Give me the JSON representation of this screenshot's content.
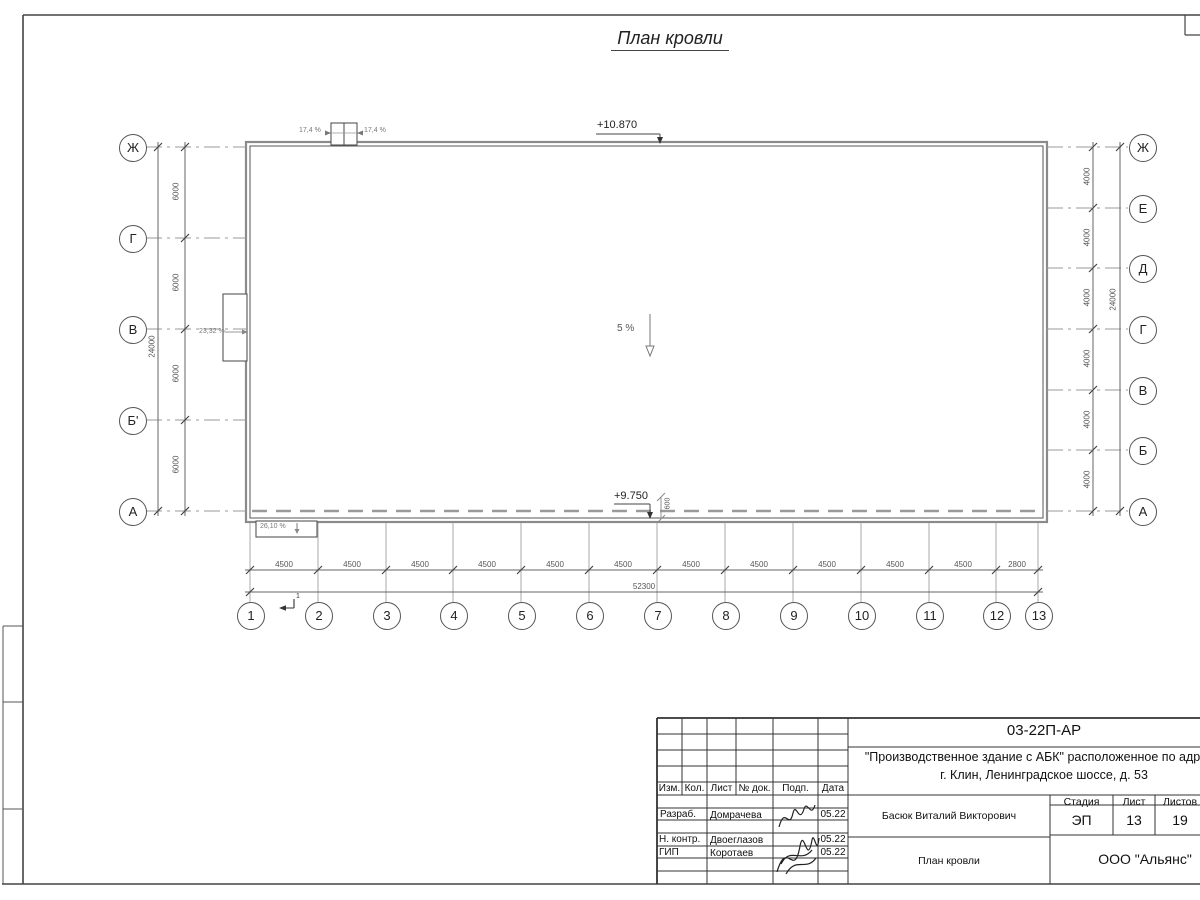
{
  "drawing": {
    "title": "План кровли"
  },
  "plan": {
    "elevation_top": "+10.870",
    "elevation_bottom": "+9.750",
    "slope_main": "5 %",
    "slope_left_canopy": "23,32 %",
    "slope_bottom_canopy": "26,10 %",
    "slope_vent_left": "17,4 %",
    "slope_vent_right": "17,4 %",
    "parapet_dim": "600",
    "section_mark": "1"
  },
  "axes": {
    "left": [
      "Ж",
      "Г",
      "В",
      "Б'",
      "А"
    ],
    "right": [
      "Ж",
      "Е",
      "Д",
      "Г",
      "В",
      "Б",
      "А"
    ],
    "bottom": [
      "1",
      "2",
      "3",
      "4",
      "5",
      "6",
      "7",
      "8",
      "9",
      "10",
      "11",
      "12",
      "13"
    ]
  },
  "dims": {
    "bottom_segments": [
      "4500",
      "4500",
      "4500",
      "4500",
      "4500",
      "4500",
      "4500",
      "4500",
      "4500",
      "4500",
      "4500",
      "2800"
    ],
    "bottom_total": "52300",
    "left_segments": [
      "6000",
      "6000",
      "6000",
      "6000"
    ],
    "left_total": "24000",
    "right_segments": [
      "4000",
      "4000",
      "4000",
      "4000",
      "4000",
      "4000"
    ],
    "right_total": "24000"
  },
  "titleblock": {
    "doc_code": "03-22П-АР",
    "project_line1": "\"Производственное здание с АБК\" расположенное по адресу:",
    "project_line2": "г. Клин, Ленинградское шоссе, д. 53",
    "header_cols": [
      "Изм.",
      "Кол.",
      "Лист",
      "№ док.",
      "Подп.",
      "Дата"
    ],
    "rows": [
      {
        "role": "Разраб.",
        "name": "Домрачева",
        "date": "05.22"
      },
      {
        "role": "Н. контр.",
        "name": "Двоеглазов",
        "date": "05.22"
      },
      {
        "role": "ГИП",
        "name": "Коротаев",
        "date": "05.22"
      }
    ],
    "approver": "Басюк Виталий Викторович",
    "stage_label": "Стадия",
    "sheet_label": "Лист",
    "sheets_label": "Листов",
    "stage": "ЭП",
    "sheet": "13",
    "sheets": "19",
    "sheet_title": "План кровли",
    "company": "ООО \"Альянс\""
  }
}
